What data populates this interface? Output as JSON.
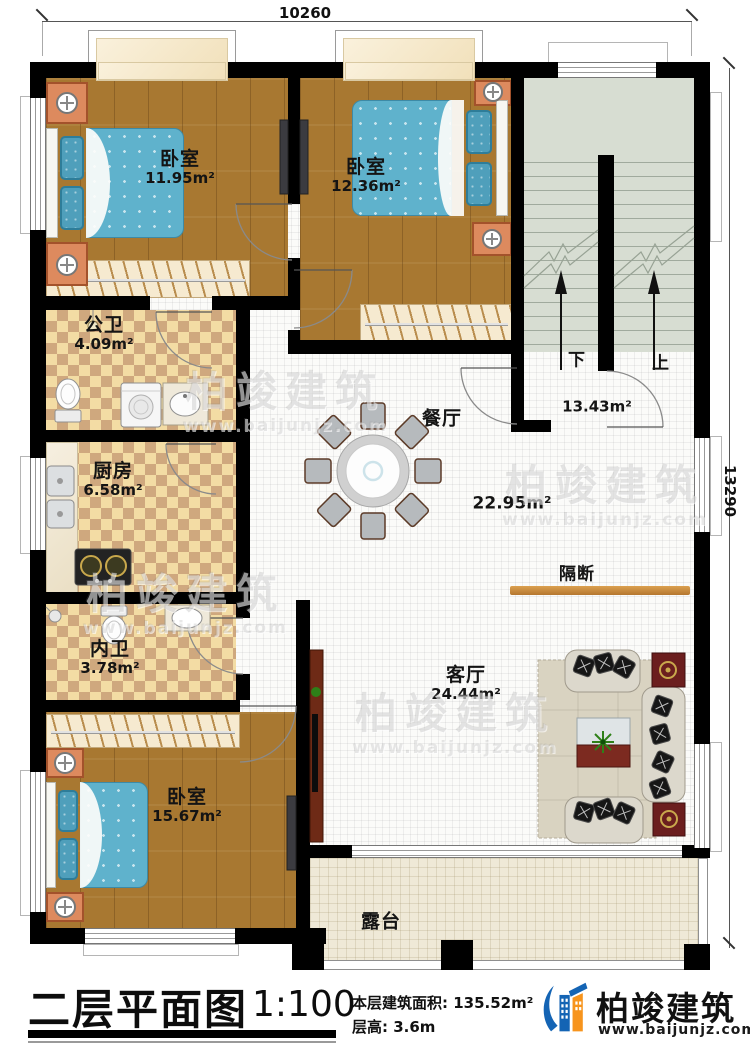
{
  "dimensions": {
    "top": "10260",
    "right": "13290"
  },
  "rooms": {
    "bedroom1": {
      "name": "卧室",
      "area": "11.95m²"
    },
    "bedroom2": {
      "name": "卧室",
      "area": "12.36m²"
    },
    "public_bath": {
      "name": "公卫",
      "area": "4.09m²"
    },
    "kitchen": {
      "name": "厨房",
      "area": "6.58m²"
    },
    "dining": {
      "name": "餐厅",
      "area": "22.95m²"
    },
    "inner_bath": {
      "name": "内卫",
      "area": "3.78m²"
    },
    "bedroom3": {
      "name": "卧室",
      "area": "15.67m²"
    },
    "living": {
      "name": "客厅",
      "area": "24.44m²"
    },
    "partition": {
      "name": "隔断"
    },
    "terrace": {
      "name": "露台"
    },
    "stairwell": {
      "down": "下",
      "up": "上",
      "area": "13.43m²"
    }
  },
  "title_block": {
    "title": "二层平面图",
    "scale": "1:100",
    "floor_area_label": "本层建筑面积: 135.52m²",
    "floor_height_label": "层高: 3.6m"
  },
  "brand": {
    "name": "柏竣建筑",
    "website": "www.baijunjz.com"
  },
  "watermark": {
    "name": "柏竣建筑",
    "website": "www.baijunjz.com"
  },
  "colors": {
    "wall": "#000000",
    "wood": "#a87831",
    "tile_light": "#f3dca4",
    "tile_dark": "#cfa87e",
    "stair": "#d7ddd2",
    "terrace": "#efe9d7",
    "blanket": "#5fb2cc",
    "nightstand": "#dd8a5e",
    "logo_blue": "#1464b4",
    "logo_orange": "#f7941d"
  }
}
